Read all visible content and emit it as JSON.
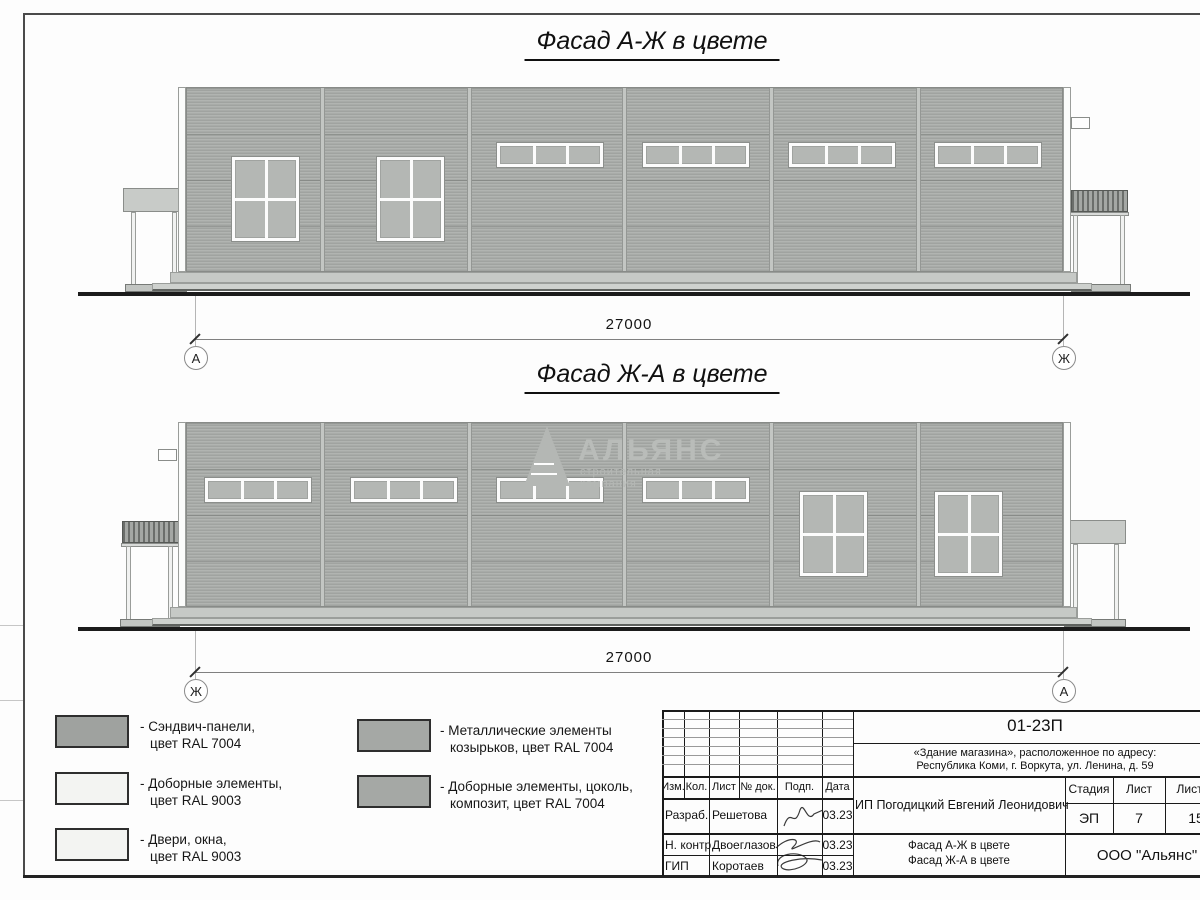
{
  "titles": {
    "facade1": "Фасад А-Ж в цвете",
    "facade2": "Фасад Ж-А в цвете"
  },
  "watermark": {
    "name": "АЛЬЯНС",
    "subtitle": "строительная компания"
  },
  "legend": {
    "items": [
      {
        "line1": "- Сэндвич-панели,",
        "line2": "цвет RAL 7004",
        "color": "#9fa29f"
      },
      {
        "line1": "- Доборные элементы,",
        "line2": "цвет RAL 9003",
        "color": "#f3f4f2"
      },
      {
        "line1": "- Двери, окна,",
        "line2": "цвет RAL 9003",
        "color": "#f3f4f2"
      },
      {
        "line1": "- Металлические элементы",
        "line2": "козырьков, цвет RAL 7004",
        "color": "#a5a8a5"
      },
      {
        "line1": "- Доборные элементы, цоколь,",
        "line2": "композит, цвет RAL 7004",
        "color": "#a5a8a5"
      }
    ]
  },
  "title_block": {
    "doc_code": "01-23П",
    "project_line1": "«Здание магазина», расположенное по адресу:",
    "project_line2": "Республика Коми, г. Воркута, ул. Ленина, д. 59",
    "client": "ИП Погодицкий Евгений Леонидович",
    "columns": [
      "Изм.",
      "Кол.",
      "Лист",
      "№ док.",
      "Подп.",
      "Дата"
    ],
    "stage_header": [
      "Стадия",
      "Лист",
      "Листов"
    ],
    "stage_values": [
      "ЭП",
      "7",
      "15"
    ],
    "sheet_title_line1": "Фасад А-Ж в цвете",
    "sheet_title_line2": "Фасад Ж-А в цвете",
    "company": "ООО \"Альянс\"",
    "rows": [
      {
        "role": "Разраб.",
        "name": "Решетова",
        "date": "03.23"
      },
      {
        "role": "Н. контр.",
        "name": "Двоеглазов",
        "date": "03.23"
      },
      {
        "role": "ГИП",
        "name": "Коротаев",
        "date": "03.23"
      }
    ]
  },
  "drawing": {
    "facades": [
      {
        "id": "facade-a-zh",
        "wall": {
          "x": 186,
          "y": 87,
          "w": 877,
          "h": 185
        },
        "joints": [
          320,
          467,
          622,
          769,
          916
        ],
        "strip_windows": {
          "y": 143,
          "w": 106,
          "h": 24,
          "x": [
            497,
            643,
            789,
            935
          ]
        },
        "large_windows": {
          "y": 157,
          "w": 67,
          "h": 84,
          "x": [
            232,
            377
          ]
        },
        "vent": {
          "x": 1071,
          "y": 117,
          "w": 19,
          "h": 12
        },
        "canopies": [
          {
            "style": "plain",
            "x": 123,
            "y": 188,
            "w": 64,
            "h": 24,
            "posts": [
              131,
              172
            ],
            "post_bottom": 285,
            "ramp": {
              "x": 125,
              "y": 284,
              "w": 62,
              "h": 8
            }
          },
          {
            "style": "corrugated",
            "x": 1071,
            "y": 190,
            "w": 57,
            "h": 22,
            "posts": [
              1073,
              1120
            ],
            "post_bottom": 285,
            "ramp": {
              "x": 1071,
              "y": 284,
              "w": 60,
              "h": 8
            }
          }
        ],
        "base_upper": {
          "x": 170,
          "y": 272,
          "w": 907,
          "h": 11
        },
        "base_lower": {
          "x": 152,
          "y": 283,
          "w": 940,
          "h": 8
        },
        "ground": {
          "x": 78,
          "y": 292,
          "w": 1112,
          "h": 4
        },
        "dimension": {
          "label": "27000",
          "left_axis": "А",
          "right_axis": "Ж",
          "left_x": 195,
          "right_x": 1063,
          "ext_top": 296,
          "line_y": 339,
          "label_y": 316,
          "circle_y": 357
        }
      },
      {
        "id": "facade-zh-a",
        "wall": {
          "x": 186,
          "y": 422,
          "w": 877,
          "h": 185
        },
        "joints": [
          320,
          467,
          622,
          769,
          916
        ],
        "strip_windows": {
          "y": 478,
          "w": 106,
          "h": 24,
          "x": [
            205,
            351,
            497,
            643
          ]
        },
        "large_windows": {
          "y": 492,
          "w": 67,
          "h": 84,
          "x": [
            800,
            935
          ]
        },
        "vent": {
          "x": 158,
          "y": 449,
          "w": 19,
          "h": 12
        },
        "canopies": [
          {
            "style": "corrugated",
            "x": 122,
            "y": 521,
            "w": 57,
            "h": 22,
            "posts": [
              126,
              168
            ],
            "post_bottom": 620,
            "ramp": {
              "x": 120,
              "y": 619,
              "w": 60,
              "h": 8
            }
          },
          {
            "style": "plain",
            "x": 1062,
            "y": 520,
            "w": 64,
            "h": 24,
            "posts": [
              1073,
              1114
            ],
            "post_bottom": 620,
            "ramp": {
              "x": 1064,
              "y": 619,
              "w": 62,
              "h": 8
            }
          }
        ],
        "base_upper": {
          "x": 170,
          "y": 607,
          "w": 907,
          "h": 11
        },
        "base_lower": {
          "x": 152,
          "y": 618,
          "w": 940,
          "h": 8
        },
        "ground": {
          "x": 78,
          "y": 627,
          "w": 1112,
          "h": 4
        },
        "dimension": {
          "label": "27000",
          "left_axis": "Ж",
          "right_axis": "А",
          "left_x": 195,
          "right_x": 1063,
          "ext_top": 631,
          "line_y": 672,
          "label_y": 649,
          "circle_y": 690
        }
      }
    ]
  }
}
